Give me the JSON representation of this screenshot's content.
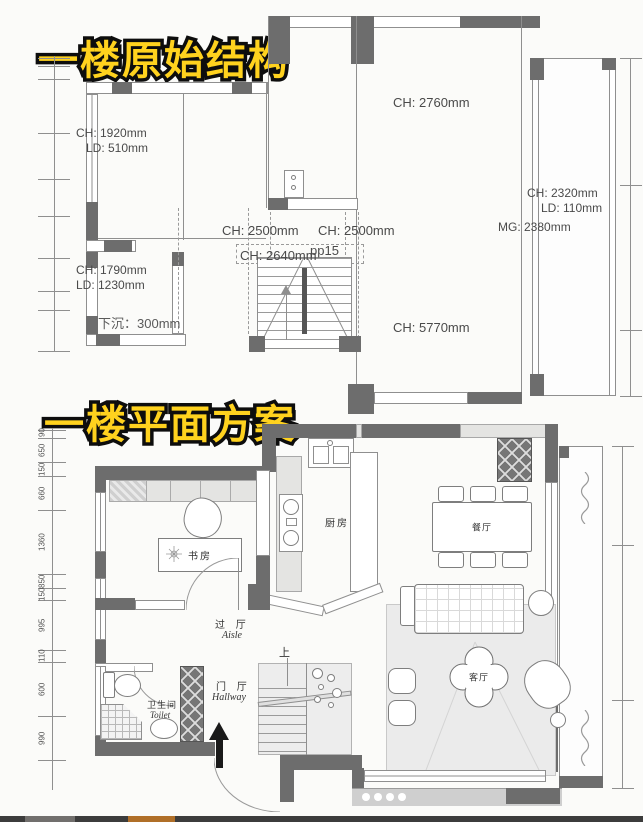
{
  "original": {
    "title": "一楼原始结构",
    "dims": {
      "ch2760": "CH: 2760mm",
      "ch1920": "CH: 1920mm",
      "ld510": "LD: 510mm",
      "ch2500a": "CH: 2500mm",
      "ch2500b": "CH: 2500mm",
      "ch2640": "CH: 2640mm",
      "pp15": "pp15",
      "ch1790": "CH: 1790mm",
      "ld1230": "LD: 1230mm",
      "sunken": "下沉：300mm",
      "ch2320": "CH: 2320mm",
      "ld110": "LD: 110mm",
      "mg2380": "MG: 2380mm",
      "ch5770": "CH: 5770mm"
    }
  },
  "scheme": {
    "title": "一楼平面方案",
    "rooms": {
      "study": "书房",
      "kitchen": "厨房",
      "dining": "餐厅",
      "living": "客厅",
      "aisle_zh": "过 厅",
      "aisle_en": "Aisle",
      "hallway_zh": "门 厅",
      "hallway_en": "Hallway",
      "toilet_zh": "卫生间",
      "toilet_en": "Toilet",
      "stair_up": "上"
    },
    "ruler_left": [
      "90",
      "650",
      "150",
      "660",
      "1360",
      "850",
      "150",
      "995",
      "110",
      "600",
      "990"
    ]
  },
  "colors": {
    "title_yellow": "#FFD21E",
    "wall_dark": "#6D6D6D",
    "scrub_orange": "#B06F28"
  }
}
